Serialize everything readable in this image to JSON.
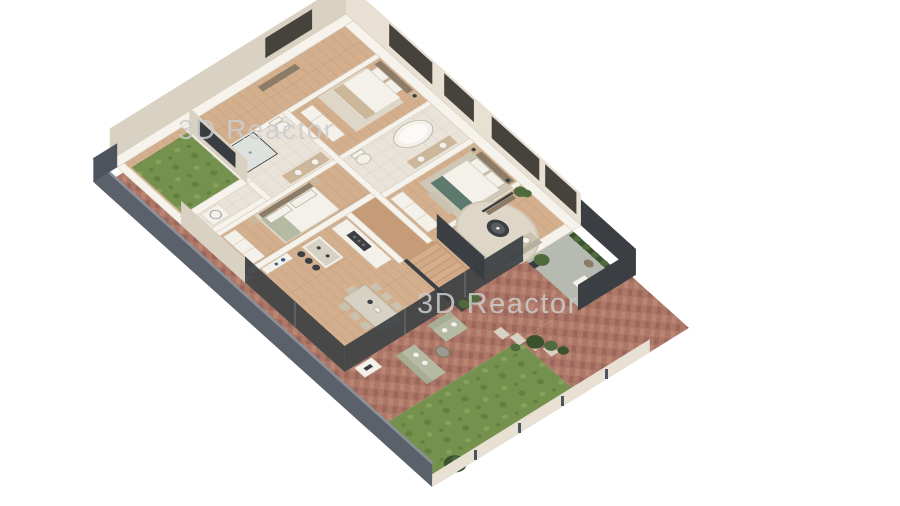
{
  "watermarks": [
    {
      "text": "3D Reactor"
    },
    {
      "text": "3D Reactor"
    }
  ],
  "scene": {
    "kind": "isometric-3d-floor-plan-render",
    "areas": [
      "entrance-hall",
      "bedroom-1",
      "ensuite-bathroom",
      "master-bedroom",
      "living-room",
      "bathroom",
      "bedroom-2",
      "utility-room",
      "corridor",
      "staircase",
      "kitchen",
      "dining-area",
      "covered-patio",
      "terrace",
      "courtyard-lawn",
      "side-path",
      "garden-lawn",
      "brick-patio"
    ],
    "elements": [
      "bed",
      "wardrobe",
      "nightstand",
      "freestanding-bathtub",
      "vanity",
      "toilet",
      "shower",
      "corner-sofa",
      "round-rug",
      "coffee-table",
      "tv-console",
      "potted-plant",
      "kitchen-island",
      "bar-stools",
      "cooktop-counter",
      "dining-table",
      "dining-chairs",
      "outdoor-sofa",
      "outdoor-side-table",
      "stepping-stones",
      "shrubs",
      "boundary-wall",
      "garden-fence"
    ]
  },
  "palette": {
    "paper": "#ffffff",
    "watermark": "#cdcdcd",
    "wall_top": "#f6f3ec",
    "wall_stroke": "#d8d1c3",
    "cream_face": "#e7e0d3",
    "cream_face_dark": "#d9d1c2",
    "slate": "#5a616b",
    "slate_dark": "#4d545e",
    "slate_light": "#8a919b",
    "frame_dark": "#46423c",
    "glass_dark": "#393d41",
    "wood": "#d3af8d",
    "wood_dark": "#c69b77",
    "wood_line": "#a97f5e",
    "tile": "#e9e3d9",
    "tile_line": "#d3ccc0",
    "brick": "#ad7768",
    "brick_light": "#ba8573",
    "brick_dark": "#9c675b",
    "lawn": "#75914e",
    "lawn_dark": "#628040",
    "lawn_light": "#86a25d",
    "concrete": "#b6bab0",
    "rug": "#ded7c8",
    "rug_dark": "#cfc7b6",
    "fabric": "#cac2b1",
    "fabric_dark": "#b8b09e",
    "sage": "#b4bba2",
    "sage_dark": "#a6ad93",
    "teal": "#5e7a6f",
    "furn_white": "#f4f1ea",
    "furn_wood": "#cdb79a",
    "dark_wood": "#8b7b67",
    "charcoal": "#3b3e42",
    "coffee_inner": "#5a5e60",
    "plant": "#4f6b3d",
    "plant_dark": "#3b522e",
    "stone": "#d7d1c3",
    "shower": "#dde2df",
    "blue_accent": "#3a5f8a"
  }
}
